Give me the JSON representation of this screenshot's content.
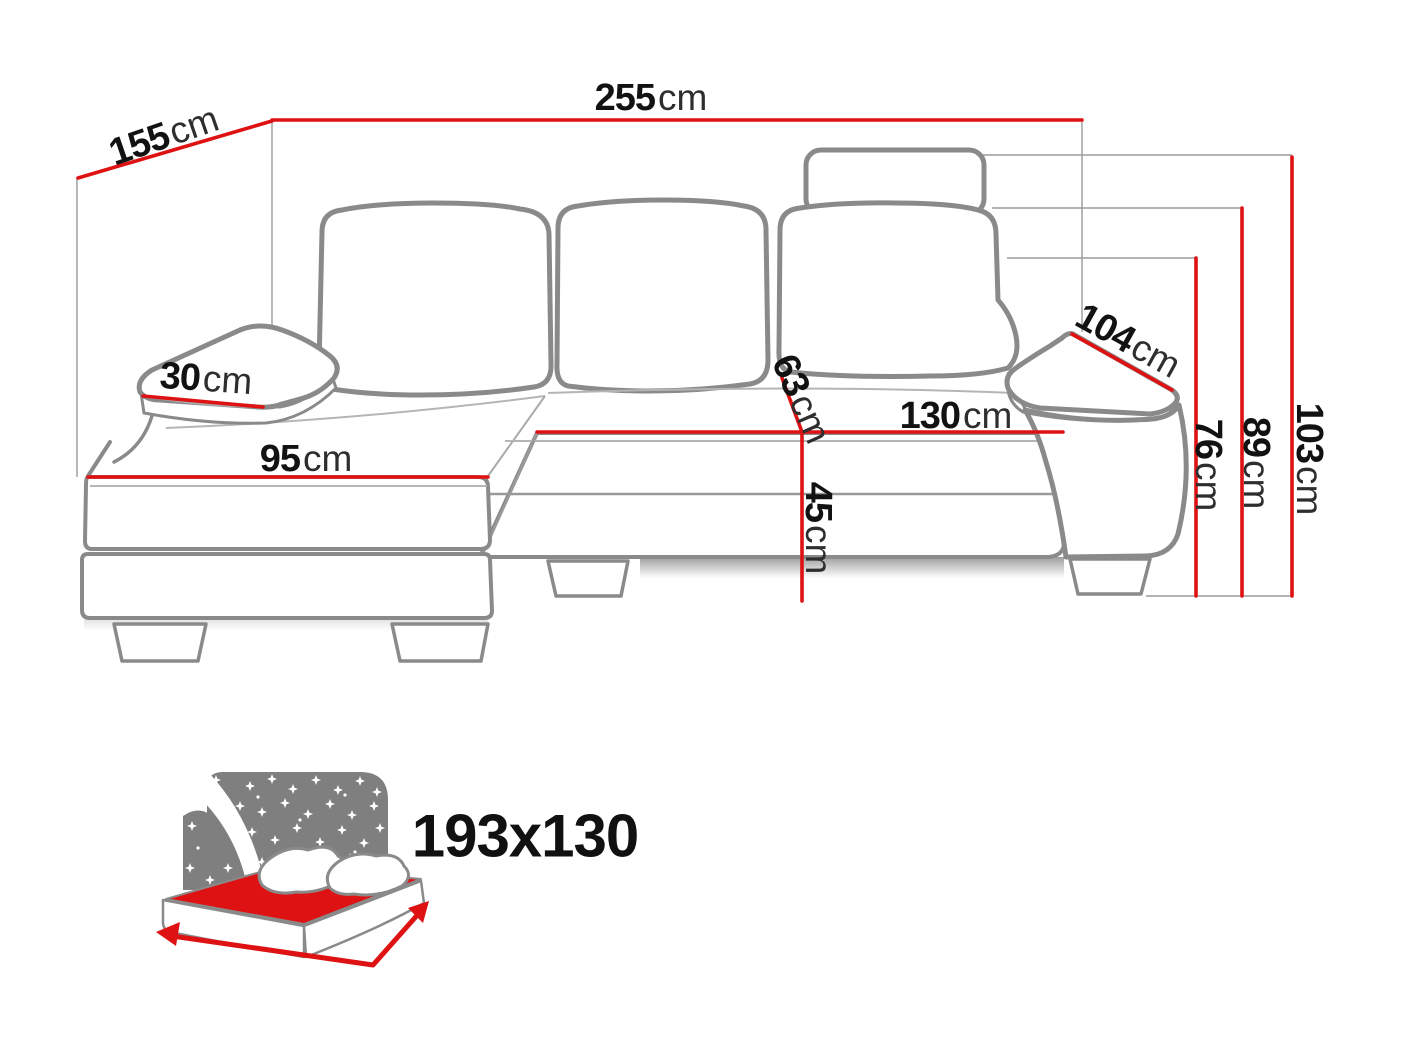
{
  "title": "Corner sofa dimensions diagram",
  "colors": {
    "accent_red": "#de1212",
    "outline_gray": "#8a8a8a",
    "text_black": "#121212"
  },
  "dimensions": {
    "total_width": {
      "value": "255",
      "unit": "cm"
    },
    "total_depth": {
      "value": "155",
      "unit": "cm"
    },
    "left_armrest_width": {
      "value": "30",
      "unit": "cm"
    },
    "chaise_width": {
      "value": "95",
      "unit": "cm"
    },
    "seat_depth": {
      "value": "63",
      "unit": "cm"
    },
    "seat_width": {
      "value": "130",
      "unit": "cm"
    },
    "seat_height": {
      "value": "45",
      "unit": "cm"
    },
    "right_armrest_length": {
      "value": "104",
      "unit": "cm"
    },
    "armrest_height": {
      "value": "76",
      "unit": "cm"
    },
    "backrest_height": {
      "value": "89",
      "unit": "cm"
    },
    "total_height": {
      "value": "103",
      "unit": "cm"
    }
  },
  "sleeping_area": {
    "size_label": "193x130",
    "icon": "sleeping-function-icon"
  }
}
